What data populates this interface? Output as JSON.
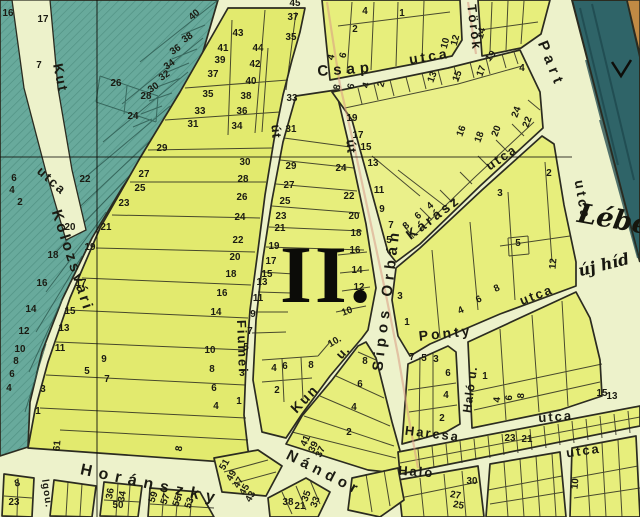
{
  "map": {
    "district_label": "II.",
    "palette": {
      "cream": "#edf2cb",
      "teal": "#68aa9c",
      "tealHatch": "#3d7c6e",
      "yellow": "#e7ee7c",
      "yellowAlt": "#e2ea6e",
      "yellowPale": "#eaf08a",
      "river": "#2f6468",
      "riverDark": "#1d474c",
      "orange": "#c18a44",
      "line": "#2b2b20",
      "label": "#1b1b12",
      "rose": "#d89a84"
    },
    "street_labels": [
      {
        "text": "Kut",
        "x": 56,
        "y": 79,
        "rot": 78,
        "size": 14,
        "ls": 2
      },
      {
        "text": "utca",
        "x": 49,
        "y": 184,
        "rot": 42,
        "size": 13,
        "ls": 2
      },
      {
        "text": "Kolozsvári",
        "x": 68,
        "y": 262,
        "rot": 72,
        "size": 15,
        "ls": 3
      },
      {
        "text": "Fiumei",
        "x": 238,
        "y": 347,
        "rot": 88,
        "size": 13,
        "ls": 2
      },
      {
        "text": "út",
        "x": 272,
        "y": 132,
        "rot": 85,
        "size": 13,
        "ls": 1
      },
      {
        "text": "út",
        "x": 347,
        "y": 147,
        "rot": 85,
        "size": 13,
        "ls": 1
      },
      {
        "text": "Csap",
        "x": 346,
        "y": 74,
        "rot": -4,
        "size": 15,
        "ls": 5
      },
      {
        "text": "utca",
        "x": 430,
        "y": 61,
        "rot": -9,
        "size": 14,
        "ls": 3
      },
      {
        "text": "Török",
        "x": 470,
        "y": 28,
        "rot": 83,
        "size": 13,
        "ls": 2
      },
      {
        "text": "Part",
        "x": 547,
        "y": 66,
        "rot": 68,
        "size": 15,
        "ls": 5
      },
      {
        "text": "Kárász",
        "x": 436,
        "y": 221,
        "rot": -37,
        "size": 14,
        "ls": 3
      },
      {
        "text": "utca",
        "x": 504,
        "y": 161,
        "rot": -34,
        "size": 13,
        "ls": 2
      },
      {
        "text": "utca",
        "x": 578,
        "y": 201,
        "rot": 80,
        "size": 14,
        "ls": 3
      },
      {
        "text": "Sipos Orbán",
        "x": 391,
        "y": 300,
        "rot": -83,
        "size": 15,
        "ls": 5
      },
      {
        "text": "Kun",
        "x": 308,
        "y": 402,
        "rot": -46,
        "size": 14,
        "ls": 2
      },
      {
        "text": "u.",
        "x": 346,
        "y": 355,
        "rot": -46,
        "size": 13,
        "ls": 1
      },
      {
        "text": "Nándor",
        "x": 322,
        "y": 477,
        "rot": 27,
        "size": 15,
        "ls": 5
      },
      {
        "text": "Ponty",
        "x": 446,
        "y": 338,
        "rot": -6,
        "size": 14,
        "ls": 3
      },
      {
        "text": "utca",
        "x": 538,
        "y": 299,
        "rot": -21,
        "size": 13,
        "ls": 2
      },
      {
        "text": "Haló u.",
        "x": 474,
        "y": 390,
        "rot": -82,
        "size": 12,
        "ls": 1
      },
      {
        "text": "Harcsa",
        "x": 432,
        "y": 438,
        "rot": 7,
        "size": 13,
        "ls": 2
      },
      {
        "text": "utca",
        "x": 556,
        "y": 421,
        "rot": -4,
        "size": 13,
        "ls": 2
      },
      {
        "text": "Haló",
        "x": 416,
        "y": 476,
        "rot": 4,
        "size": 13,
        "ls": 2
      },
      {
        "text": "utca",
        "x": 584,
        "y": 455,
        "rot": -8,
        "size": 13,
        "ls": 2
      },
      {
        "text": "Horánszky",
        "x": 150,
        "y": 489,
        "rot": 12,
        "size": 16,
        "ls": 7
      },
      {
        "text": "lgou.",
        "x": 44,
        "y": 494,
        "rot": 82,
        "size": 10,
        "ls": 1
      }
    ],
    "handwriting": [
      {
        "text": "Lébe",
        "x": 612,
        "y": 228,
        "rot": 10,
        "size": 27
      },
      {
        "text": "új híd",
        "x": 605,
        "y": 270,
        "rot": -14,
        "size": 16
      }
    ],
    "parcel_numbers": [
      {
        "t": "16",
        "x": 8,
        "y": 16
      },
      {
        "t": "17",
        "x": 43,
        "y": 22
      },
      {
        "t": "7",
        "x": 39,
        "y": 68
      },
      {
        "t": "26",
        "x": 116,
        "y": 86
      },
      {
        "t": "28",
        "x": 146,
        "y": 99
      },
      {
        "t": "24",
        "x": 133,
        "y": 119
      },
      {
        "t": "40",
        "x": 196,
        "y": 17,
        "r": -40
      },
      {
        "t": "38",
        "x": 189,
        "y": 40,
        "r": -35
      },
      {
        "t": "36",
        "x": 177,
        "y": 52,
        "r": -35
      },
      {
        "t": "34",
        "x": 171,
        "y": 67,
        "r": -35
      },
      {
        "t": "32",
        "x": 166,
        "y": 78,
        "r": -35
      },
      {
        "t": "30",
        "x": 155,
        "y": 90,
        "r": -35
      },
      {
        "t": "22",
        "x": 85,
        "y": 182
      },
      {
        "t": "20",
        "x": 70,
        "y": 230
      },
      {
        "t": "18",
        "x": 53,
        "y": 258
      },
      {
        "t": "16",
        "x": 42,
        "y": 286
      },
      {
        "t": "14",
        "x": 31,
        "y": 312
      },
      {
        "t": "12",
        "x": 24,
        "y": 334
      },
      {
        "t": "10",
        "x": 20,
        "y": 352
      },
      {
        "t": "8",
        "x": 16,
        "y": 364
      },
      {
        "t": "6",
        "x": 12,
        "y": 377
      },
      {
        "t": "4",
        "x": 9,
        "y": 391
      },
      {
        "t": "6",
        "x": 14,
        "y": 181
      },
      {
        "t": "4",
        "x": 12,
        "y": 193
      },
      {
        "t": "2",
        "x": 20,
        "y": 205
      },
      {
        "t": "43",
        "x": 238,
        "y": 36
      },
      {
        "t": "44",
        "x": 258,
        "y": 51
      },
      {
        "t": "42",
        "x": 255,
        "y": 67
      },
      {
        "t": "40",
        "x": 251,
        "y": 84
      },
      {
        "t": "38",
        "x": 246,
        "y": 99
      },
      {
        "t": "36",
        "x": 242,
        "y": 114
      },
      {
        "t": "34",
        "x": 237,
        "y": 129
      },
      {
        "t": "45",
        "x": 295,
        "y": 6
      },
      {
        "t": "37",
        "x": 293,
        "y": 20
      },
      {
        "t": "35",
        "x": 291,
        "y": 40
      },
      {
        "t": "41",
        "x": 223,
        "y": 51
      },
      {
        "t": "39",
        "x": 220,
        "y": 63
      },
      {
        "t": "37",
        "x": 213,
        "y": 77
      },
      {
        "t": "35",
        "x": 208,
        "y": 97
      },
      {
        "t": "33",
        "x": 200,
        "y": 114
      },
      {
        "t": "31",
        "x": 193,
        "y": 127
      },
      {
        "t": "29",
        "x": 162,
        "y": 151
      },
      {
        "t": "27",
        "x": 144,
        "y": 177
      },
      {
        "t": "25",
        "x": 140,
        "y": 191
      },
      {
        "t": "23",
        "x": 124,
        "y": 206
      },
      {
        "t": "21",
        "x": 106,
        "y": 230
      },
      {
        "t": "19",
        "x": 90,
        "y": 250
      },
      {
        "t": "17",
        "x": 81,
        "y": 286
      },
      {
        "t": "15",
        "x": 70,
        "y": 314
      },
      {
        "t": "13",
        "x": 64,
        "y": 331
      },
      {
        "t": "11",
        "x": 60,
        "y": 351
      },
      {
        "t": "9",
        "x": 104,
        "y": 362
      },
      {
        "t": "5",
        "x": 87,
        "y": 374
      },
      {
        "t": "7",
        "x": 107,
        "y": 382
      },
      {
        "t": "3",
        "x": 43,
        "y": 392
      },
      {
        "t": "1",
        "x": 38,
        "y": 414
      },
      {
        "t": "61",
        "x": 60,
        "y": 446,
        "r": -85
      },
      {
        "t": "8",
        "x": 182,
        "y": 449,
        "r": -80
      },
      {
        "t": "30",
        "x": 245,
        "y": 165
      },
      {
        "t": "28",
        "x": 243,
        "y": 182
      },
      {
        "t": "26",
        "x": 242,
        "y": 200
      },
      {
        "t": "24",
        "x": 240,
        "y": 220
      },
      {
        "t": "22",
        "x": 238,
        "y": 243
      },
      {
        "t": "20",
        "x": 235,
        "y": 260
      },
      {
        "t": "18",
        "x": 231,
        "y": 277
      },
      {
        "t": "16",
        "x": 222,
        "y": 296
      },
      {
        "t": "14",
        "x": 216,
        "y": 315
      },
      {
        "t": "10",
        "x": 210,
        "y": 353
      },
      {
        "t": "8",
        "x": 212,
        "y": 372
      },
      {
        "t": "6",
        "x": 214,
        "y": 391
      },
      {
        "t": "4",
        "x": 216,
        "y": 409
      },
      {
        "t": "33",
        "x": 292,
        "y": 101
      },
      {
        "t": "31",
        "x": 291,
        "y": 132
      },
      {
        "t": "29",
        "x": 291,
        "y": 169
      },
      {
        "t": "27",
        "x": 289,
        "y": 188
      },
      {
        "t": "25",
        "x": 285,
        "y": 204
      },
      {
        "t": "23",
        "x": 281,
        "y": 219
      },
      {
        "t": "21",
        "x": 280,
        "y": 231
      },
      {
        "t": "19",
        "x": 274,
        "y": 249
      },
      {
        "t": "17",
        "x": 271,
        "y": 264
      },
      {
        "t": "15",
        "x": 267,
        "y": 277
      },
      {
        "t": "13",
        "x": 262,
        "y": 285
      },
      {
        "t": "11",
        "x": 258,
        "y": 301
      },
      {
        "t": "9",
        "x": 253,
        "y": 317
      },
      {
        "t": "7",
        "x": 250,
        "y": 334
      },
      {
        "t": "5",
        "x": 246,
        "y": 350
      },
      {
        "t": "3",
        "x": 242,
        "y": 376
      },
      {
        "t": "1",
        "x": 239,
        "y": 404
      },
      {
        "t": "24",
        "x": 341,
        "y": 171
      },
      {
        "t": "22",
        "x": 349,
        "y": 199
      },
      {
        "t": "20",
        "x": 354,
        "y": 219
      },
      {
        "t": "18",
        "x": 356,
        "y": 236
      },
      {
        "t": "16",
        "x": 355,
        "y": 253
      },
      {
        "t": "14",
        "x": 357,
        "y": 273
      },
      {
        "t": "12",
        "x": 359,
        "y": 290
      },
      {
        "t": "10",
        "x": 348,
        "y": 314,
        "r": -20
      },
      {
        "t": "10.",
        "x": 336,
        "y": 344,
        "r": -30
      },
      {
        "t": "4",
        "x": 274,
        "y": 371
      },
      {
        "t": "6",
        "x": 285,
        "y": 369
      },
      {
        "t": "8",
        "x": 311,
        "y": 368
      },
      {
        "t": "2",
        "x": 277,
        "y": 393
      },
      {
        "t": "19",
        "x": 352,
        "y": 121
      },
      {
        "t": "17",
        "x": 358,
        "y": 138
      },
      {
        "t": "15",
        "x": 366,
        "y": 150
      },
      {
        "t": "13",
        "x": 373,
        "y": 166
      },
      {
        "t": "11",
        "x": 379,
        "y": 193
      },
      {
        "t": "9",
        "x": 382,
        "y": 212
      },
      {
        "t": "7",
        "x": 391,
        "y": 228
      },
      {
        "t": "5",
        "x": 389,
        "y": 243
      },
      {
        "t": "13",
        "x": 435,
        "y": 78,
        "r": -70
      },
      {
        "t": "15",
        "x": 460,
        "y": 77,
        "r": -70
      },
      {
        "t": "17",
        "x": 484,
        "y": 72,
        "r": -70
      },
      {
        "t": "19",
        "x": 493,
        "y": 58,
        "r": -50
      },
      {
        "t": "4",
        "x": 522,
        "y": 71
      },
      {
        "t": "24",
        "x": 519,
        "y": 113,
        "r": -70
      },
      {
        "t": "22",
        "x": 530,
        "y": 123,
        "r": -70
      },
      {
        "t": "20",
        "x": 499,
        "y": 132,
        "r": -70
      },
      {
        "t": "18",
        "x": 482,
        "y": 138,
        "r": -70
      },
      {
        "t": "16",
        "x": 464,
        "y": 132,
        "r": -70
      },
      {
        "t": "8",
        "x": 408,
        "y": 228,
        "r": -40
      },
      {
        "t": "6",
        "x": 420,
        "y": 218,
        "r": -40
      },
      {
        "t": "4",
        "x": 432,
        "y": 208,
        "r": -40
      },
      {
        "t": "8",
        "x": 340,
        "y": 88,
        "r": -75
      },
      {
        "t": "6",
        "x": 354,
        "y": 87,
        "r": -75
      },
      {
        "t": "4",
        "x": 369,
        "y": 86,
        "r": -75
      },
      {
        "t": "2",
        "x": 384,
        "y": 85,
        "r": -75
      },
      {
        "t": "4",
        "x": 334,
        "y": 58,
        "r": -75
      },
      {
        "t": "6",
        "x": 346,
        "y": 56,
        "r": -75
      },
      {
        "t": "4",
        "x": 365,
        "y": 14
      },
      {
        "t": "2",
        "x": 355,
        "y": 32
      },
      {
        "t": "1",
        "x": 402,
        "y": 16
      },
      {
        "t": "10",
        "x": 448,
        "y": 44,
        "r": -75
      },
      {
        "t": "12",
        "x": 458,
        "y": 41,
        "r": -75
      },
      {
        "t": "14",
        "x": 484,
        "y": 34,
        "r": -75
      },
      {
        "t": "2",
        "x": 549,
        "y": 176
      },
      {
        "t": "3",
        "x": 500,
        "y": 196
      },
      {
        "t": "5",
        "x": 518,
        "y": 246
      },
      {
        "t": "12",
        "x": 556,
        "y": 264,
        "r": -85
      },
      {
        "t": "3",
        "x": 400,
        "y": 299
      },
      {
        "t": "1",
        "x": 407,
        "y": 325
      },
      {
        "t": "8",
        "x": 498,
        "y": 291,
        "r": -25
      },
      {
        "t": "6",
        "x": 480,
        "y": 302,
        "r": -25
      },
      {
        "t": "4",
        "x": 462,
        "y": 313,
        "r": -25
      },
      {
        "t": "7",
        "x": 412,
        "y": 360
      },
      {
        "t": "5",
        "x": 424,
        "y": 361
      },
      {
        "t": "3",
        "x": 436,
        "y": 362
      },
      {
        "t": "6",
        "x": 448,
        "y": 376
      },
      {
        "t": "4",
        "x": 446,
        "y": 398
      },
      {
        "t": "2",
        "x": 442,
        "y": 421
      },
      {
        "t": "1",
        "x": 485,
        "y": 379
      },
      {
        "t": "15",
        "x": 602,
        "y": 396
      },
      {
        "t": "13",
        "x": 612,
        "y": 399
      },
      {
        "t": "4",
        "x": 500,
        "y": 400,
        "r": -85
      },
      {
        "t": "6",
        "x": 512,
        "y": 398,
        "r": -85
      },
      {
        "t": "8",
        "x": 524,
        "y": 396,
        "r": -85
      },
      {
        "t": "23",
        "x": 510,
        "y": 441
      },
      {
        "t": "21",
        "x": 527,
        "y": 442
      },
      {
        "t": "30",
        "x": 472,
        "y": 484
      },
      {
        "t": "27",
        "x": 455,
        "y": 498,
        "r": 10
      },
      {
        "t": "25",
        "x": 458,
        "y": 508,
        "r": 10
      },
      {
        "t": "10",
        "x": 578,
        "y": 484,
        "r": -85
      },
      {
        "t": "51",
        "x": 227,
        "y": 466,
        "r": -60
      },
      {
        "t": "49",
        "x": 234,
        "y": 477,
        "r": -60
      },
      {
        "t": "47",
        "x": 241,
        "y": 484,
        "r": -60
      },
      {
        "t": "45",
        "x": 247,
        "y": 491,
        "r": -60
      },
      {
        "t": "43",
        "x": 253,
        "y": 498,
        "r": -60
      },
      {
        "t": "38",
        "x": 288,
        "y": 505
      },
      {
        "t": "21",
        "x": 300,
        "y": 509
      },
      {
        "t": "35",
        "x": 309,
        "y": 497,
        "r": -70
      },
      {
        "t": "33",
        "x": 318,
        "y": 503,
        "r": -70
      },
      {
        "t": "41",
        "x": 308,
        "y": 442,
        "r": -65
      },
      {
        "t": "39",
        "x": 316,
        "y": 448,
        "r": -65
      },
      {
        "t": "37",
        "x": 323,
        "y": 453,
        "r": -65
      },
      {
        "t": "2",
        "x": 349,
        "y": 435
      },
      {
        "t": "8",
        "x": 365,
        "y": 364
      },
      {
        "t": "6",
        "x": 360,
        "y": 387
      },
      {
        "t": "4",
        "x": 354,
        "y": 410
      },
      {
        "t": "8",
        "x": 18,
        "y": 486,
        "r": -15
      },
      {
        "t": "23",
        "x": 14,
        "y": 505
      },
      {
        "t": "36",
        "x": 113,
        "y": 494,
        "r": -80
      },
      {
        "t": "34",
        "x": 125,
        "y": 497,
        "r": -80
      },
      {
        "t": "50",
        "x": 118,
        "y": 508
      },
      {
        "t": "59",
        "x": 156,
        "y": 498,
        "r": -70
      },
      {
        "t": "57",
        "x": 168,
        "y": 500,
        "r": -70
      },
      {
        "t": "55",
        "x": 180,
        "y": 502,
        "r": -70
      },
      {
        "t": "53",
        "x": 192,
        "y": 504,
        "r": -70
      }
    ]
  }
}
